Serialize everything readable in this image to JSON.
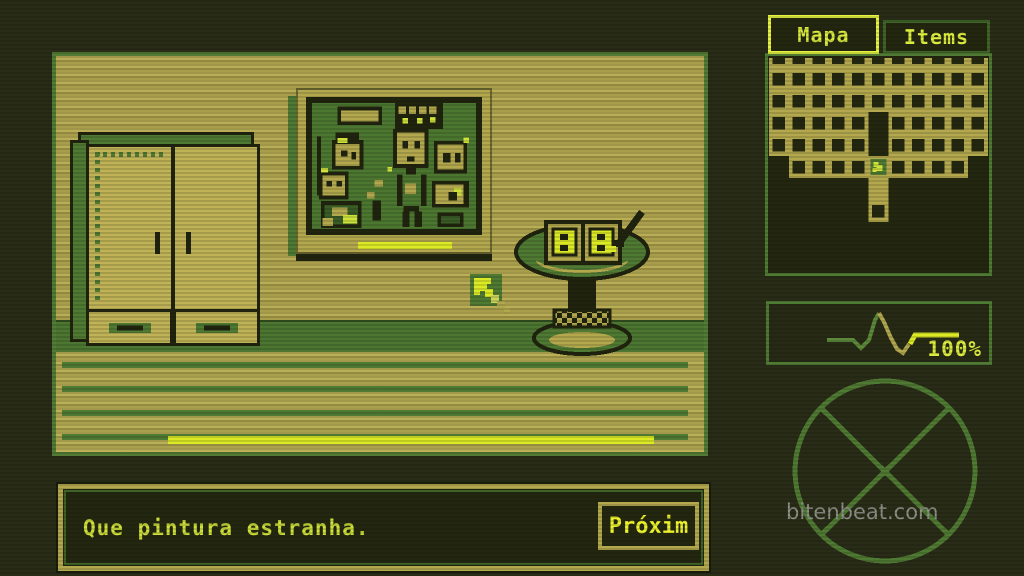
{
  "colors": {
    "background": "#292c16",
    "wall_tan": "#b9ad55",
    "outline_dark": "#20240f",
    "green_mid": "#4f7a33",
    "green_panel_border": "#4f7a33",
    "highlight_yellow": "#dcea25",
    "text_yellow_green": "#cfe03a",
    "tab_active_border": "#e6f340",
    "frame_khaki": "#b4a84f",
    "painting_canvas_green": "#4c7731",
    "watermark_gray": "#8f9088"
  },
  "sidebar": {
    "tabs": [
      {
        "label": "Mapa",
        "active": true
      },
      {
        "label": "Items",
        "active": false
      }
    ],
    "health": {
      "value": "100%",
      "ekg": {
        "green": "58,36 84,36 92,44 100,36 106,16 110,9",
        "tan": "110,9 115,18 122,34 128,45 134,49 140,40",
        "yellow": "141,40 146,31 190,31"
      }
    }
  },
  "map": {
    "legend": "n=top-notch  #=room-cell  O=open-slot  ==corridor  P=player  .=void",
    "rows": [
      "nnnnnnnnnnn",
      "###########",
      "###########",
      "#####O#####",
      "#####O#####",
      ".####P####.",
      ".....=.....",
      ".....#....."
    ]
  },
  "painting": {
    "pixels": [
      [
        22,
        4,
        48,
        20,
        "K"
      ],
      [
        26,
        8,
        40,
        12,
        "T"
      ],
      [
        84,
        0,
        52,
        28,
        "K"
      ],
      [
        88,
        4,
        8,
        8,
        "T"
      ],
      [
        99,
        4,
        8,
        8,
        "T"
      ],
      [
        110,
        4,
        8,
        8,
        "T"
      ],
      [
        121,
        4,
        8,
        8,
        "T"
      ],
      [
        92,
        16,
        6,
        6,
        "Y"
      ],
      [
        108,
        16,
        6,
        6,
        "Y"
      ],
      [
        122,
        15,
        6,
        6,
        "Y"
      ],
      [
        82,
        28,
        38,
        42,
        "K"
      ],
      [
        86,
        32,
        30,
        34,
        "T"
      ],
      [
        92,
        41,
        6,
        8,
        "K"
      ],
      [
        105,
        41,
        6,
        8,
        "K"
      ],
      [
        97,
        58,
        8,
        5,
        "K"
      ],
      [
        96,
        70,
        11,
        7,
        "K"
      ],
      [
        86,
        77,
        6,
        34,
        "K"
      ],
      [
        112,
        77,
        6,
        34,
        "K"
      ],
      [
        95,
        87,
        12,
        11,
        "T"
      ],
      [
        93,
        111,
        17,
        6,
        "K"
      ],
      [
        92,
        117,
        8,
        17,
        "K"
      ],
      [
        105,
        117,
        8,
        17,
        "K"
      ],
      [
        20,
        32,
        25,
        8,
        "K"
      ],
      [
        16,
        40,
        34,
        32,
        "K"
      ],
      [
        20,
        44,
        26,
        24,
        "T"
      ],
      [
        22,
        38,
        11,
        5,
        "Y"
      ],
      [
        26,
        51,
        7,
        7,
        "K"
      ],
      [
        37,
        53,
        5,
        8,
        "K"
      ],
      [
        2,
        74,
        32,
        30,
        "K"
      ],
      [
        6,
        78,
        24,
        22,
        "T"
      ],
      [
        10,
        84,
        6,
        6,
        "K"
      ],
      [
        21,
        84,
        6,
        6,
        "K"
      ],
      [
        4,
        70,
        8,
        5,
        "Y"
      ],
      [
        4,
        106,
        44,
        29,
        "K"
      ],
      [
        8,
        110,
        36,
        21,
        "G"
      ],
      [
        16,
        113,
        17,
        9,
        "T"
      ],
      [
        28,
        121,
        15,
        9,
        "Y"
      ],
      [
        6,
        124,
        11,
        9,
        "T"
      ],
      [
        62,
        83,
        9,
        7,
        "T"
      ],
      [
        76,
        69,
        5,
        5,
        "Y"
      ],
      [
        54,
        96,
        8,
        7,
        "T"
      ],
      [
        60,
        105,
        9,
        22,
        "K"
      ],
      [
        126,
        41,
        36,
        35,
        "K"
      ],
      [
        130,
        45,
        28,
        27,
        "T"
      ],
      [
        136,
        54,
        8,
        10,
        "K"
      ],
      [
        149,
        54,
        6,
        10,
        "K"
      ],
      [
        158,
        37,
        6,
        6,
        "Y"
      ],
      [
        124,
        84,
        40,
        29,
        "K"
      ],
      [
        128,
        88,
        30,
        21,
        "T"
      ],
      [
        148,
        92,
        8,
        8,
        "Y"
      ],
      [
        142,
        96,
        9,
        9,
        "K"
      ],
      [
        130,
        118,
        28,
        16,
        "K"
      ],
      [
        134,
        122,
        20,
        8,
        "G"
      ],
      [
        0,
        36,
        4,
        64,
        "K"
      ]
    ]
  },
  "dialog": {
    "text": "Que pintura estranha.",
    "next_label": "Próxim"
  },
  "watermark": {
    "text": "bitenbeat.com"
  },
  "icons": {
    "cursor": "pixel-arrow-up-left",
    "player_marker": "yellow-pixel-figure",
    "heartbeat": "ekg-pulse-line",
    "compass": "circle-with-x"
  }
}
